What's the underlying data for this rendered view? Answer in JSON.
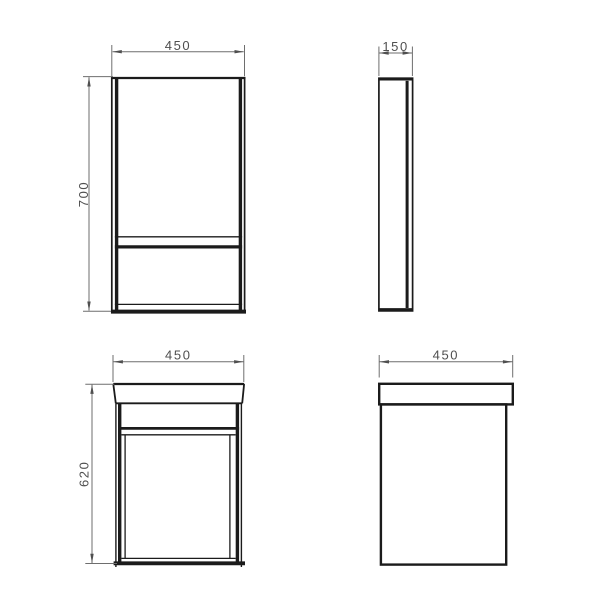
{
  "page": {
    "background_color": "#ffffff"
  },
  "drawing": {
    "type": "technical-dimension-drawing",
    "colors": {
      "object_line": "#1b1b1b",
      "dimension_line": "#6e6e6e",
      "dimension_text": "#4f4f4f"
    },
    "views": {
      "mirror_front": {
        "width_label": "450",
        "height_label": "700"
      },
      "mirror_side": {
        "depth_label": "150"
      },
      "vanity_front": {
        "width_label": "450",
        "height_label": "620"
      },
      "vanity_side": {
        "width_label": "450"
      }
    }
  }
}
